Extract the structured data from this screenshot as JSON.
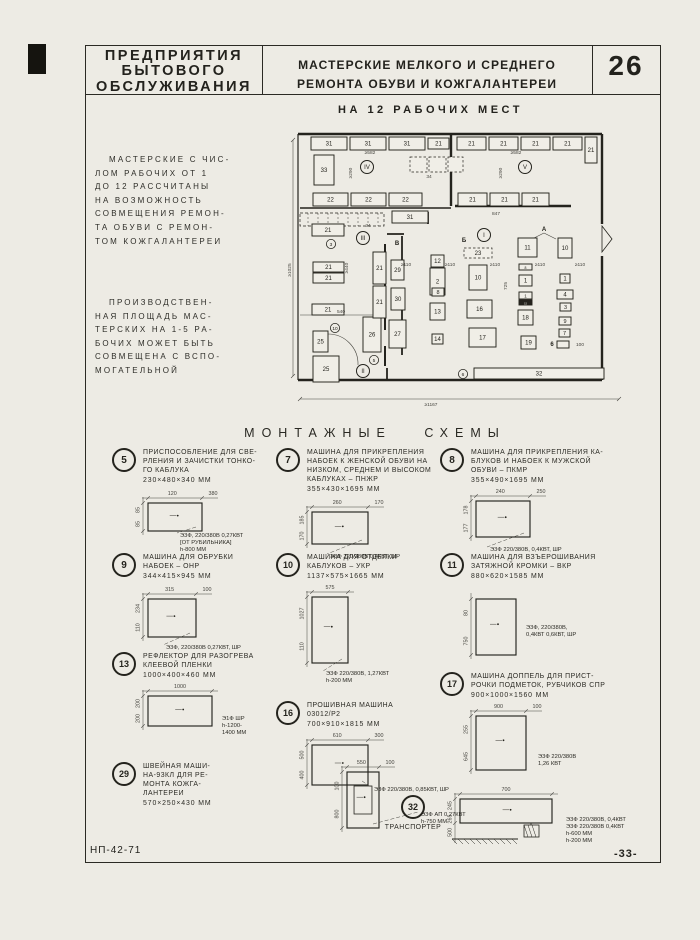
{
  "colors": {
    "ink": "#24231d",
    "dim": "#45443e",
    "paper": "#edebe4"
  },
  "header": {
    "org": "ПРЕДПРИЯТИЯ\nБЫТОВОГО\nОБСЛУЖИВАНИЯ",
    "title": "МАСТЕРСКИЕ МЕЛКОГО И СРЕДНЕГО\nРЕМОНТА ОБУВИ И КОЖГАЛАНТЕРЕИ",
    "page_num": "26"
  },
  "intro": {
    "para1": "МАСТЕРСКИЕ С ЧИС-\nЛОМ РАБОЧИХ ОТ 1\nДО 12 РАССЧИТАНЫ\nНА ВОЗМОЖНОСТЬ\nСОВМЕЩЕНИЯ РЕМОН-\nТА ОБУВИ С РЕМОН-\nТОМ КОЖГАЛАНТЕРЕИ",
    "para2": "ПРОИЗВОДСТВЕН-\nНАЯ ПЛОЩАДЬ МАС-\nТЕРСКИХ НА 1-5 РА-\nБОЧИХ МОЖЕТ БЫТЬ\nСОВМЕЩЕНА С ВСПО-\nМОГАТЕЛЬНОЙ"
  },
  "section": {
    "title": "МОНТАЖНЫЕ СХЕМЫ"
  },
  "footer": {
    "left": "НП-42-71",
    "right": "-33-"
  },
  "plan": {
    "title": "НА 12 РАБОЧИХ МЕСТ",
    "walls": [
      [
        8,
        16,
        312,
        16,
        2.4
      ],
      [
        312,
        16,
        312,
        106,
        2.4
      ],
      [
        312,
        138,
        312,
        262,
        2.4
      ],
      [
        8,
        262,
        312,
        262,
        2.4
      ],
      [
        8,
        16,
        8,
        262,
        1.2
      ],
      [
        161,
        16,
        161,
        88,
        2.4
      ],
      [
        10,
        90,
        161,
        90,
        1.4
      ],
      [
        165,
        88,
        281,
        88,
        2.6
      ],
      [
        95,
        126,
        95,
        212,
        2.0
      ],
      [
        95,
        228,
        95,
        248,
        2.0
      ],
      [
        112,
        118,
        112,
        150,
        1.8
      ],
      [
        112,
        170,
        112,
        237,
        1.8
      ],
      [
        97,
        116,
        114,
        116,
        1.8
      ],
      [
        138,
        94,
        138,
        106,
        1.8
      ],
      [
        97,
        250,
        97,
        262,
        1.8
      ]
    ],
    "thin": [
      [
        10,
        281,
        329,
        281
      ],
      [
        3,
        22,
        3,
        258
      ],
      [
        10,
        197,
        94,
        197
      ],
      [
        8,
        283,
        12,
        279
      ],
      [
        327,
        283,
        331,
        279
      ],
      [
        1,
        24,
        5,
        20
      ],
      [
        1,
        260,
        5,
        256
      ],
      [
        254,
        115,
        242,
        121
      ],
      [
        254,
        115,
        266,
        121
      ]
    ],
    "band": [
      10,
      95,
      84,
      13
    ],
    "arc": "M38,216 A30,30 0 0 1 68,247",
    "door": "312,108 322,121 312,134",
    "boxes": [
      [
        21,
        19,
        36,
        13,
        "31"
      ],
      [
        60,
        19,
        36,
        13,
        "31"
      ],
      [
        99,
        19,
        36,
        13,
        "31"
      ],
      [
        138,
        20,
        21,
        11,
        "21"
      ],
      [
        167,
        19,
        29,
        13,
        "21"
      ],
      [
        199,
        19,
        29,
        13,
        "21"
      ],
      [
        231,
        19,
        29,
        13,
        "21"
      ],
      [
        263,
        19,
        29,
        13,
        "21"
      ],
      [
        295,
        19,
        12,
        26,
        "21"
      ],
      [
        24,
        37,
        20,
        30,
        "33"
      ],
      [
        120,
        39,
        17,
        15,
        "",
        "d"
      ],
      [
        139,
        39,
        17,
        15,
        "",
        "d"
      ],
      [
        158,
        39,
        15,
        15,
        "",
        "d"
      ],
      [
        23,
        75,
        35,
        13,
        "22"
      ],
      [
        61,
        75,
        35,
        13,
        "22"
      ],
      [
        99,
        75,
        33,
        13,
        "22"
      ],
      [
        168,
        75,
        29,
        13,
        "21"
      ],
      [
        200,
        75,
        29,
        13,
        "21"
      ],
      [
        232,
        75,
        27,
        13,
        "21"
      ],
      [
        102,
        93,
        36,
        12,
        "31"
      ],
      [
        22,
        106,
        32,
        12,
        "21"
      ],
      [
        23,
        144,
        31,
        10,
        "21"
      ],
      [
        23,
        155,
        31,
        10,
        "21"
      ],
      [
        22,
        186,
        32,
        11,
        "21"
      ],
      [
        23,
        213,
        15,
        21,
        "25"
      ],
      [
        23,
        238,
        26,
        26,
        "25"
      ],
      [
        73,
        199,
        18,
        35,
        "26"
      ],
      [
        99,
        202,
        17,
        28,
        "27"
      ],
      [
        83,
        134,
        13,
        32,
        "21"
      ],
      [
        83,
        168,
        13,
        32,
        "21"
      ],
      [
        101,
        142,
        13,
        20,
        "29"
      ],
      [
        101,
        170,
        14,
        22,
        "30"
      ],
      [
        141,
        137,
        13,
        12,
        "12"
      ],
      [
        140,
        150,
        15,
        27,
        "2"
      ],
      [
        142,
        170,
        12,
        8,
        "8"
      ],
      [
        140,
        185,
        15,
        17,
        "13"
      ],
      [
        142,
        216,
        11,
        10,
        "14"
      ],
      [
        174,
        130,
        28,
        10,
        "23",
        "d"
      ],
      [
        179,
        147,
        18,
        25,
        "10"
      ],
      [
        177,
        182,
        25,
        18,
        "16"
      ],
      [
        179,
        210,
        27,
        19,
        "17"
      ],
      [
        228,
        120,
        19,
        19,
        "11"
      ],
      [
        268,
        120,
        14,
        20,
        "10"
      ],
      [
        229,
        146,
        13,
        6,
        "8"
      ],
      [
        229,
        157,
        13,
        11,
        "1"
      ],
      [
        229,
        174,
        13,
        7,
        "1"
      ],
      [
        229,
        182,
        13,
        5,
        "15",
        "f"
      ],
      [
        228,
        192,
        15,
        15,
        "18"
      ],
      [
        231,
        218,
        15,
        13,
        "19"
      ],
      [
        270,
        156,
        10,
        9,
        "1"
      ],
      [
        267,
        172,
        16,
        9,
        "4"
      ],
      [
        270,
        185,
        11,
        8,
        "3"
      ],
      [
        269,
        199,
        12,
        8,
        "9"
      ],
      [
        269,
        211,
        11,
        8,
        "7"
      ],
      [
        267,
        223,
        12,
        7,
        ""
      ],
      [
        184,
        250,
        130,
        11,
        "32"
      ]
    ],
    "rooms": [
      [
        "IV",
        77,
        49
      ],
      [
        "V",
        235,
        49
      ],
      [
        "III",
        73,
        120
      ],
      [
        "I",
        194,
        117
      ],
      [
        "II",
        73,
        253
      ]
    ],
    "circnums": [
      [
        "3",
        41,
        126
      ],
      [
        "10",
        45,
        210
      ],
      [
        "5",
        84,
        242
      ],
      [
        "6",
        173,
        256
      ]
    ],
    "letters": [
      [
        "В",
        107,
        127
      ],
      [
        "Б",
        174,
        124
      ],
      [
        "А",
        254,
        113
      ],
      [
        "6",
        262,
        228
      ]
    ],
    "dims": [
      [
        "≥582",
        80,
        36,
        0
      ],
      [
        "≥582",
        226,
        36,
        0
      ],
      [
        "≥290",
        62,
        55,
        -90
      ],
      [
        "≥290",
        212,
        55,
        -90
      ],
      [
        "847",
        206,
        97,
        0
      ],
      [
        "≥440",
        58,
        150,
        -90
      ],
      [
        "540",
        51,
        195,
        0
      ],
      [
        "725",
        217,
        168,
        -90
      ],
      [
        "≥110",
        116,
        148,
        0
      ],
      [
        "≥110",
        160,
        148,
        0
      ],
      [
        "≥110",
        205,
        148,
        0
      ],
      [
        "≥110",
        250,
        148,
        0
      ],
      [
        "≥110",
        290,
        148,
        0
      ],
      [
        "100",
        290,
        228,
        0
      ],
      [
        "≥1167",
        141,
        288,
        0
      ],
      [
        "≥1025",
        1,
        152,
        -90
      ],
      [
        "34",
        139,
        60,
        0
      ],
      [
        "34",
        78,
        109,
        0
      ]
    ]
  },
  "items": [
    {
      "num": "5",
      "pos": [
        112,
        448
      ],
      "title": [
        "ПРИСПОСОБЛЕНИЕ ДЛЯ СВЕ-",
        "РЛЕНИЯ И ЗАЧИСТКИ ТОНКО-",
        "ГО КАБЛУКА"
      ],
      "size": "230×480×340 ММ",
      "schem": {
        "w": 158,
        "h": 78,
        "x0": 26,
        "y0": 16,
        "rw": 54,
        "rh": 28,
        "top": [
          "120",
          "380"
        ],
        "left": [
          "85",
          "85"
        ],
        "notes": [
          "Э3Ф, 220/380В 0,27КВТ",
          "[ОТ РУБИЛЬНИКА]",
          "h-800 ММ"
        ],
        "nx": 58,
        "ny": 50,
        "leader": true
      }
    },
    {
      "num": "7",
      "pos": [
        276,
        448
      ],
      "title": [
        "МАШИНА ДЛЯ ПРИКРЕПЛЕНИЯ",
        "НАБОЕК К ЖЕНСКОЙ ОБУВИ НА",
        "НИЗКОМ, СРЕДНЕМ И ВЫСОКОМ",
        "КАБЛУКАХ – ПНЖР"
      ],
      "size": "355×430×1695 ММ",
      "schem": {
        "w": 158,
        "h": 72,
        "x0": 26,
        "y0": 16,
        "rw": 56,
        "rh": 32,
        "top": [
          "260",
          "170"
        ],
        "left": [
          "185",
          "170"
        ],
        "notes": [
          "Э3Ф 220/380В 0,4КВТ, ШР"
        ],
        "nx": 44,
        "ny": 62,
        "leader": true
      }
    },
    {
      "num": "8",
      "pos": [
        440,
        448
      ],
      "title": [
        "МАШИНА ДЛЯ ПРИКРЕПЛЕНИЯ КА-",
        "БЛУКОВ И НАБОЕК К МУЖСКОЙ",
        "ОБУВИ – ПКМР"
      ],
      "size": "355×490×1695 ММ",
      "schem": {
        "w": 158,
        "h": 74,
        "x0": 26,
        "y0": 14,
        "rw": 54,
        "rh": 36,
        "top": [
          "240",
          "250"
        ],
        "left": [
          "178",
          "177"
        ],
        "notes": [
          "Э3Ф 220/380В, 0,4КВТ, ШР"
        ],
        "nx": 40,
        "ny": 64,
        "leader": true
      }
    },
    {
      "num": "9",
      "pos": [
        112,
        553
      ],
      "title": [
        "МАШИНА ДЛЯ ОБРУБКИ",
        "НАБОЕК – ОНР"
      ],
      "size": "344×415×945 ММ",
      "schem": {
        "w": 158,
        "h": 76,
        "x0": 26,
        "y0": 16,
        "rw": 48,
        "rh": 38,
        "top": [
          "315",
          "100"
        ],
        "left": [
          "234",
          "110"
        ],
        "notes": [
          "Э3Ф, 220/380В 0,27КВТ, ШР"
        ],
        "nx": 44,
        "ny": 66,
        "leader": true
      }
    },
    {
      "num": "10",
      "pos": [
        276,
        553
      ],
      "title": [
        "МАШИНА ДЛЯ ОТДЕЛКИ",
        "КАБЛУКОВ – УКР"
      ],
      "size": "1137×575×1665 ММ",
      "schem": {
        "w": 158,
        "h": 106,
        "x0": 26,
        "y0": 14,
        "rw": 36,
        "rh": 66,
        "top": [
          "575"
        ],
        "left": [
          "1027",
          "110"
        ],
        "notes": [
          "Э3Ф 220/380В, 1,27КВТ",
          "h-200 ММ"
        ],
        "nx": 40,
        "ny": 92,
        "leader": true
      }
    },
    {
      "num": "11",
      "pos": [
        440,
        553
      ],
      "title": [
        "МАШИНА ДЛЯ ВЗЪЕРОШИВАНИЯ",
        "ЗАТЯЖНОЙ КРОМКИ – ВКР"
      ],
      "size": "880×620×1585 ММ",
      "schem": {
        "w": 170,
        "h": 84,
        "x0": 26,
        "y0": 16,
        "rw": 40,
        "rh": 56,
        "top": [],
        "left": [
          "80",
          "750"
        ],
        "notes": [
          "Э3Ф, 220/380В,",
          "0,4КВТ 0,6КВТ, ШР"
        ],
        "nx": 76,
        "ny": 46,
        "leader": false
      }
    },
    {
      "num": "13",
      "pos": [
        112,
        652
      ],
      "title": [
        "РЕФЛЕКТОР ДЛЯ РАЗОГРЕВА",
        "КЛЕЕВОЙ ПЛЕНКИ"
      ],
      "size": "1000×400×460 ММ",
      "schem": {
        "w": 165,
        "h": 62,
        "x0": 26,
        "y0": 14,
        "rw": 64,
        "rh": 30,
        "top": [
          "1000"
        ],
        "left": [
          "200",
          "200"
        ],
        "notes": [
          "Э1Ф ШР",
          "h-1200-",
          "1400 ММ"
        ],
        "nx": 100,
        "ny": 38,
        "leader": false
      }
    },
    {
      "num": "16",
      "pos": [
        276,
        701
      ],
      "title": [
        "ПРОШИВНАЯ МАШИНА",
        "03012/Р2"
      ],
      "size": "700×910×1815 ММ",
      "schem": {
        "w": 200,
        "h": 72,
        "x0": 26,
        "y0": 14,
        "rw": 56,
        "rh": 40,
        "top": [
          "610",
          "300"
        ],
        "left": [
          "500",
          "400"
        ],
        "notes": [
          "Э3Ф 220/380В, 0,85КВТ, ШР"
        ],
        "nx": 88,
        "ny": 60,
        "leader": true
      }
    },
    {
      "num": "17",
      "pos": [
        440,
        672
      ],
      "title": [
        "МАШИНА ДОППЕЛЬ ДЛЯ ПРИСТ-",
        "РОЧКИ ПОДМЕТОК, РУБЧИКОВ СПР"
      ],
      "size": "900×1000×1560 ММ",
      "schem": {
        "w": 200,
        "h": 84,
        "x0": 26,
        "y0": 14,
        "rw": 50,
        "rh": 54,
        "top": [
          "900",
          "100"
        ],
        "left": [
          "255",
          "645"
        ],
        "notes": [
          "Э3Ф 220/380В",
          "1,26 КВТ"
        ],
        "nx": 88,
        "ny": 56,
        "leader": false
      }
    },
    {
      "num": "29",
      "pos": [
        112,
        762
      ],
      "title": [
        "ШВЕЙНАЯ МАШИ-",
        "НА-93КЛ ДЛЯ РЕ-",
        "МОНТА КОЖГА-",
        "ЛАНТЕРЕИ"
      ],
      "size": "570×250×430 ММ",
      "schem": {
        "w": 200,
        "h": 84,
        "x0": 30,
        "y0": 14,
        "rw": 32,
        "rh": 56,
        "inner": true,
        "top": [
          "550",
          "100"
        ],
        "left": [
          "100",
          "800"
        ],
        "notes": [
          "Э3Ф АП 0,27КВТ",
          "h-750 ММ"
        ],
        "nx": 104,
        "ny": 58,
        "leader": true
      }
    },
    {
      "num": "32",
      "pos": [
        378,
        795
      ],
      "title": [
        "ТРАНСПОРТЕР"
      ],
      "size": "",
      "schem": {
        "w": 258,
        "h": 78,
        "x0": 22,
        "y0": 12,
        "rw": 92,
        "rh": 24,
        "hatch": true,
        "top": [
          "700"
        ],
        "left": [
          "245",
          "265",
          "500"
        ],
        "notes": [
          "Э3Ф 220/380В, 0,4КВТ",
          "Э3Ф 220/380В 0,4КВТ",
          "h-600 ММ",
          "h-200 ММ"
        ],
        "nx": 128,
        "ny": 34,
        "leader": false
      }
    }
  ]
}
